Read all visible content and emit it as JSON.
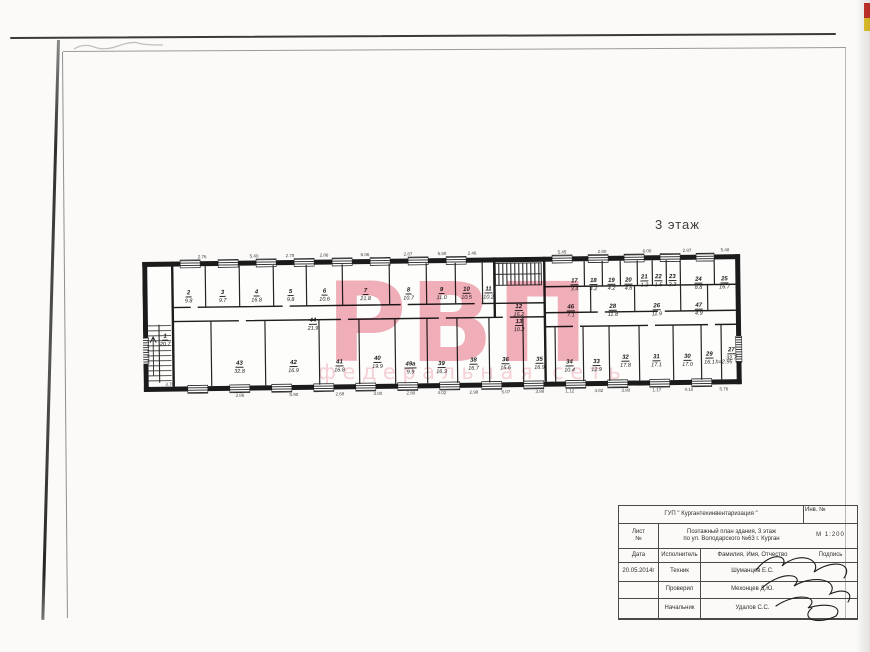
{
  "page": {
    "floor_label": "3 этаж"
  },
  "watermark": {
    "big_text": "РВП",
    "small_text": "федеральная сеть",
    "color": "#ee9aa8"
  },
  "plan": {
    "wall_color": "#1b1b1b",
    "note": "h=2.95",
    "note_pos": [
      572,
      111
    ],
    "rooms": [
      {
        "num": "2",
        "area": "9.8",
        "x": 46,
        "y": 27
      },
      {
        "num": "3",
        "area": "9.7",
        "x": 80,
        "y": 27
      },
      {
        "num": "4",
        "area": "16.8",
        "x": 114,
        "y": 27
      },
      {
        "num": "5",
        "area": "9.8",
        "x": 148,
        "y": 27
      },
      {
        "num": "6",
        "area": "10.6",
        "x": 182,
        "y": 27
      },
      {
        "num": "7",
        "area": "21.8",
        "x": 223,
        "y": 27
      },
      {
        "num": "8",
        "area": "10.7",
        "x": 266,
        "y": 27
      },
      {
        "num": "9",
        "area": "11.0",
        "x": 299,
        "y": 27
      },
      {
        "num": "10",
        "area": "10.5",
        "x": 324,
        "y": 27
      },
      {
        "num": "11",
        "area": "10.2",
        "x": 346,
        "y": 27
      },
      {
        "num": "12",
        "area": "15.2",
        "x": 376,
        "y": 45
      },
      {
        "num": "13",
        "area": "10.2",
        "x": 376,
        "y": 60
      },
      {
        "num": "17",
        "area": "3.4",
        "x": 432,
        "y": 20
      },
      {
        "num": "18",
        "area": "4.2",
        "x": 451,
        "y": 20
      },
      {
        "num": "19",
        "area": "4.2",
        "x": 469,
        "y": 20
      },
      {
        "num": "20",
        "area": "4.6",
        "x": 486,
        "y": 20
      },
      {
        "num": "21",
        "area": "1.2",
        "x": 502,
        "y": 17
      },
      {
        "num": "22",
        "area": "1.5",
        "x": 516,
        "y": 17
      },
      {
        "num": "23",
        "area": "2.3",
        "x": 530,
        "y": 17
      },
      {
        "num": "24",
        "area": "8.8",
        "x": 556,
        "y": 20
      },
      {
        "num": "25",
        "area": "16.7",
        "x": 582,
        "y": 20
      },
      {
        "num": "46",
        "area": "7.1",
        "x": 428,
        "y": 46
      },
      {
        "num": "28",
        "area": "11.8",
        "x": 470,
        "y": 46
      },
      {
        "num": "26",
        "area": "11.9",
        "x": 514,
        "y": 46
      },
      {
        "num": "47",
        "area": "4.9",
        "x": 556,
        "y": 46
      },
      {
        "num": "44",
        "area": "21.9",
        "x": 170,
        "y": 56
      },
      {
        "num": "1",
        "area": "20.7",
        "x": 22,
        "y": 70
      },
      {
        "num": "43",
        "area": "32.8",
        "x": 96,
        "y": 98
      },
      {
        "num": "42",
        "area": "16.9",
        "x": 150,
        "y": 98
      },
      {
        "num": "41",
        "area": "16.8",
        "x": 196,
        "y": 98
      },
      {
        "num": "40",
        "area": "19.9",
        "x": 234,
        "y": 95
      },
      {
        "num": "49а",
        "area": "9.9",
        "x": 267,
        "y": 101
      },
      {
        "num": "39",
        "area": "16.3",
        "x": 298,
        "y": 101
      },
      {
        "num": "38",
        "area": "16.7",
        "x": 330,
        "y": 98
      },
      {
        "num": "36",
        "area": "15.6",
        "x": 362,
        "y": 98
      },
      {
        "num": "35",
        "area": "16.9",
        "x": 396,
        "y": 98
      },
      {
        "num": "34",
        "area": "10.4",
        "x": 426,
        "y": 101
      },
      {
        "num": "33",
        "area": "12.9",
        "x": 453,
        "y": 101
      },
      {
        "num": "32",
        "area": "17.8",
        "x": 482,
        "y": 97
      },
      {
        "num": "31",
        "area": "17.1",
        "x": 513,
        "y": 97
      },
      {
        "num": "30",
        "area": "17.0",
        "x": 544,
        "y": 97
      },
      {
        "num": "29",
        "area": "16.1",
        "x": 566,
        "y": 95
      },
      {
        "num": "27",
        "area": "32.7",
        "x": 588,
        "y": 91
      }
    ],
    "dims_top": [
      {
        "v": "2.76",
        "x": 60
      },
      {
        "v": "5.40",
        "x": 112
      },
      {
        "v": "2.78",
        "x": 148
      },
      {
        "v": "2.86",
        "x": 182
      },
      {
        "v": "6.06",
        "x": 223
      },
      {
        "v": "2.87",
        "x": 266
      },
      {
        "v": "5.88",
        "x": 300
      },
      {
        "v": "2.46",
        "x": 330
      },
      {
        "v": "5.45",
        "x": 420
      },
      {
        "v": "2.80",
        "x": 460
      },
      {
        "v": "6.00",
        "x": 505
      },
      {
        "v": "2.87",
        "x": 545
      },
      {
        "v": "5.48",
        "x": 583
      }
    ],
    "dims_bottom": [
      {
        "v": "3.86",
        "x": 96
      },
      {
        "v": "5.90",
        "x": 150
      },
      {
        "v": "2.68",
        "x": 196
      },
      {
        "v": "3.00",
        "x": 234
      },
      {
        "v": "2.80",
        "x": 267
      },
      {
        "v": "4.02",
        "x": 298
      },
      {
        "v": "2.98",
        "x": 330
      },
      {
        "v": "5.07",
        "x": 362
      },
      {
        "v": "3.88",
        "x": 396
      },
      {
        "v": "1.12",
        "x": 426
      },
      {
        "v": "4.82",
        "x": 455
      },
      {
        "v": "3.80",
        "x": 482
      },
      {
        "v": "1.17",
        "x": 513
      },
      {
        "v": "4.10",
        "x": 545
      },
      {
        "v": "5.76",
        "x": 580
      }
    ],
    "dims_other": [
      {
        "v": "3.70",
        "x": 26,
        "y": 126
      }
    ]
  },
  "titleblock": {
    "org": "ГУП \" Кургантехинвентаризация \"",
    "inv_label": "Инв. №",
    "sheet_label_1": "Лист",
    "sheet_label_2": "№",
    "doc_title_line1": "Поэтажный план здания, 3 этаж",
    "doc_title_line2": "по ул. Володарского №63  г. Курган",
    "scale": "М 1:200",
    "col_date": "Дата",
    "col_role": "Исполнитель",
    "col_name": "Фамилия, Имя, Отчество",
    "col_sign": "Подпись",
    "rows": [
      {
        "date": "20.05.2014г",
        "role": "Техник",
        "name": "Шуманцев Е.С."
      },
      {
        "date": "",
        "role": "Проверил",
        "name": "Мехонцев Д.Ю."
      },
      {
        "date": "",
        "role": "Начальник",
        "name": "Удалов С.С."
      }
    ]
  }
}
